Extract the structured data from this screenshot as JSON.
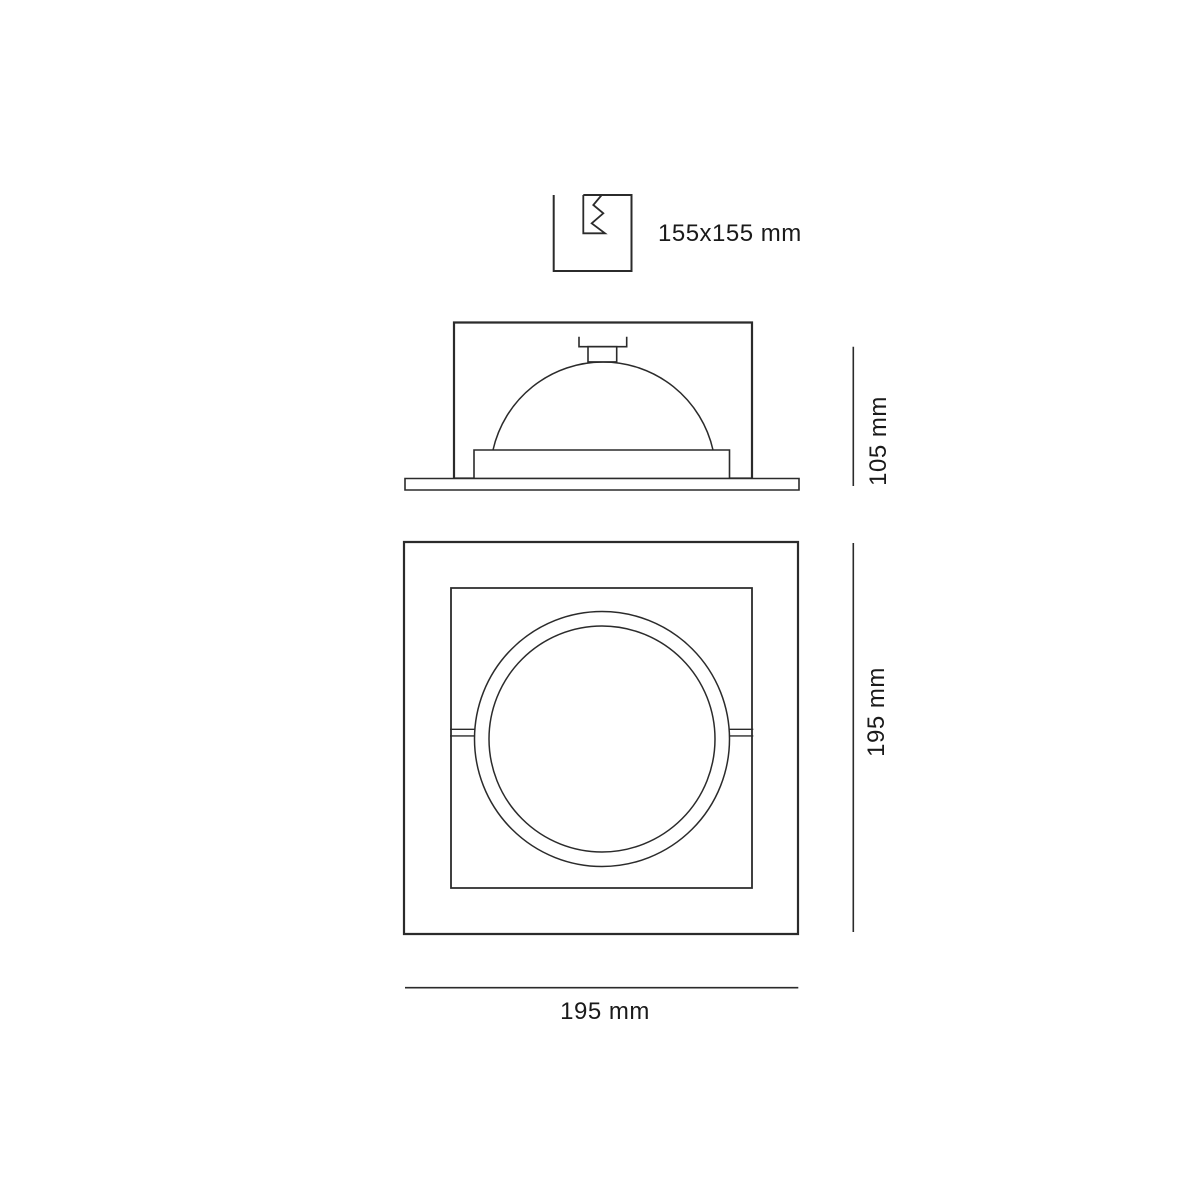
{
  "page": {
    "background": "#ffffff"
  },
  "colors": {
    "line": "#2b2b2b",
    "text": "#1a1a1a"
  },
  "drawing": {
    "type": "technical-dimension-drawing",
    "cutout_symbol": {
      "label": "155x155 mm",
      "meaning": "ceiling cut-out size",
      "width_mm": 155,
      "height_mm": 155
    },
    "side_view": {
      "height_label": "105 mm",
      "height_mm": 105
    },
    "front_view": {
      "height_label": "195 mm",
      "width_label": "195 mm",
      "width_mm": 195,
      "height_mm": 195
    }
  }
}
